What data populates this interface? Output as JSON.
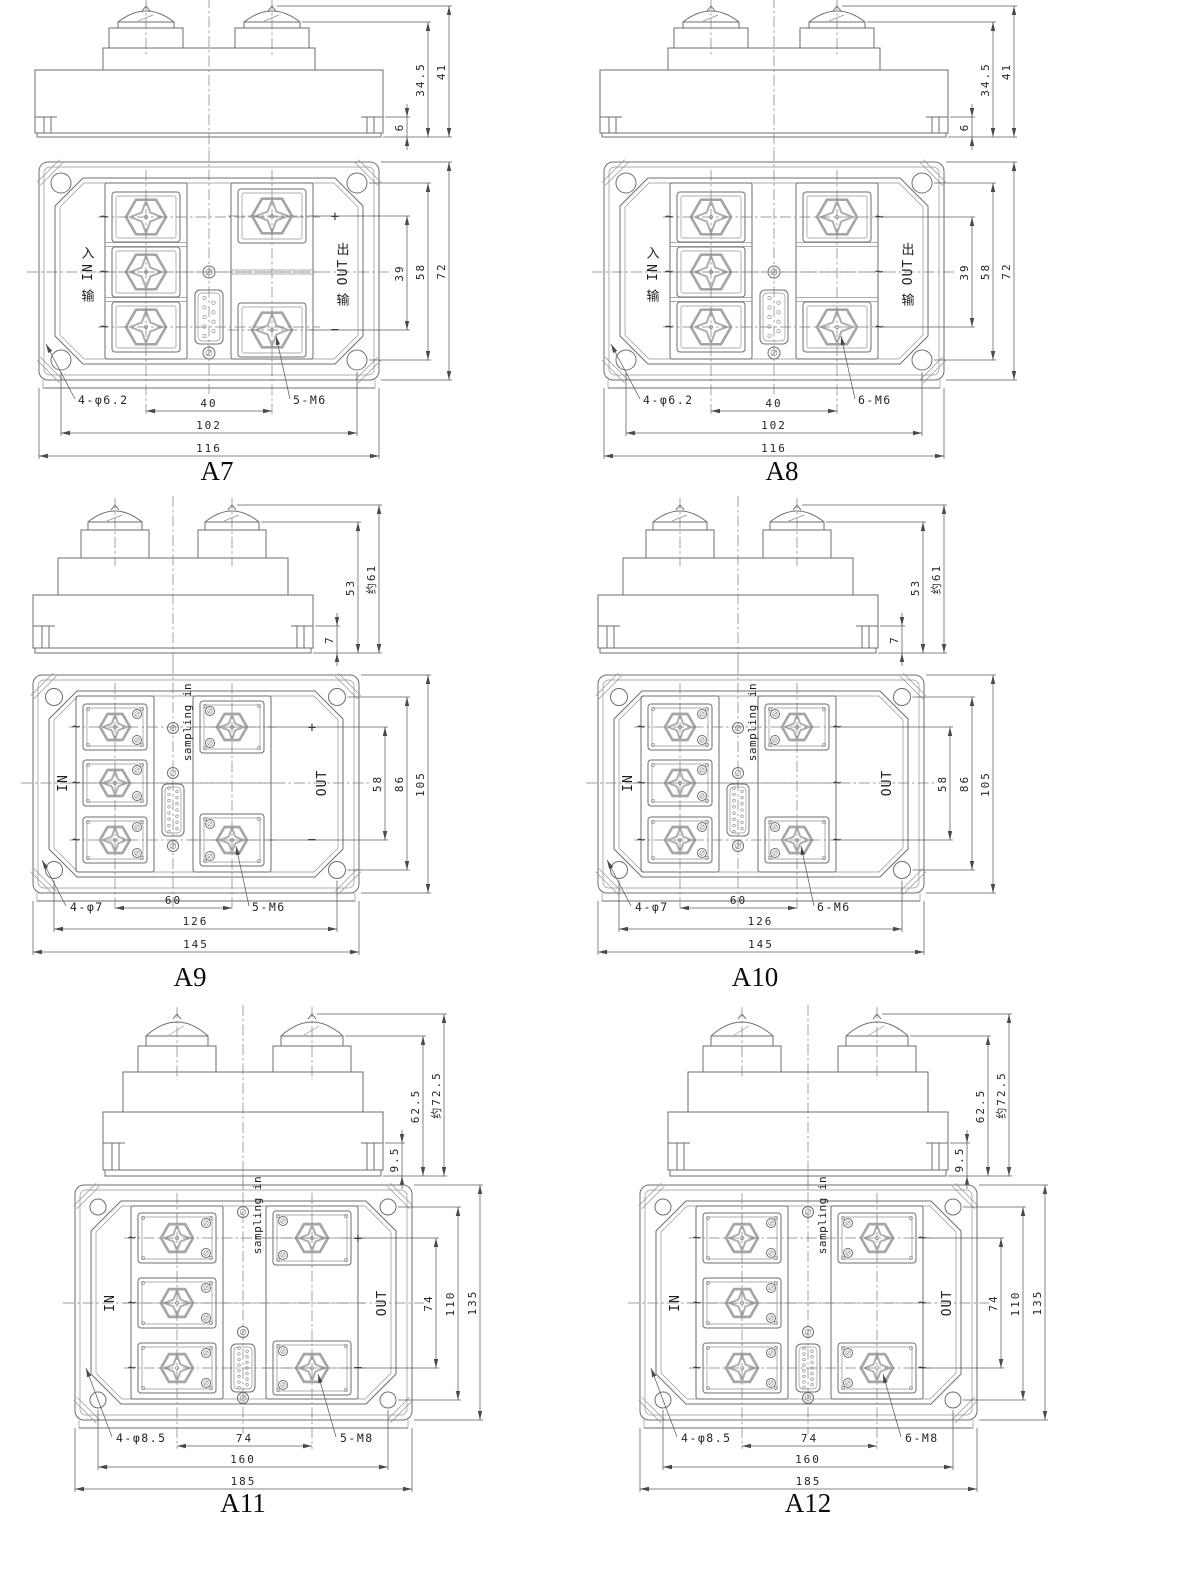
{
  "page": {
    "background": "#ffffff",
    "sheet_width": 1200,
    "sheet_height": 1596,
    "line_color": "#6e6e6e",
    "text_color": "#262626"
  },
  "symbols": {
    "plus": "+",
    "minus": "−",
    "ac_tilde": "~"
  },
  "figures": [
    {
      "id": "A7",
      "title": "A7",
      "size_class": "1",
      "style": "cn",
      "left_terminals": 3,
      "right_terminals": 2,
      "in_label": "输 IN 入",
      "out_label": "输 OUT 出",
      "sampling_label": null,
      "hole_note": "4-φ6.2",
      "terminal_note": "5-M6",
      "side_dims": [
        "6",
        "34.5",
        "41"
      ],
      "right_dims": [
        "39",
        "58",
        "72"
      ],
      "bottom_dims": [
        "40",
        "102",
        "116"
      ]
    },
    {
      "id": "A8",
      "title": "A8",
      "size_class": "1",
      "style": "cn",
      "left_terminals": 3,
      "right_terminals": 3,
      "in_label": "输 IN 入",
      "out_label": "输 OUT 出",
      "sampling_label": null,
      "hole_note": "4-φ6.2",
      "terminal_note": "6-M6",
      "side_dims": [
        "6",
        "34.5",
        "41"
      ],
      "right_dims": [
        "39",
        "58",
        "72"
      ],
      "bottom_dims": [
        "40",
        "102",
        "116"
      ]
    },
    {
      "id": "A9",
      "title": "A9",
      "size_class": "2",
      "style": "en",
      "left_terminals": 3,
      "right_terminals": 2,
      "in_label": "IN",
      "out_label": "OUT",
      "sampling_label": "sampling in",
      "hole_note": "4-φ7",
      "terminal_note": "5-M6",
      "side_dims": [
        "7",
        "53",
        "约61"
      ],
      "right_dims": [
        "58",
        "86",
        "105"
      ],
      "bottom_dims": [
        "60",
        "126",
        "145"
      ]
    },
    {
      "id": "A10",
      "title": "A10",
      "size_class": "2",
      "style": "en",
      "left_terminals": 3,
      "right_terminals": 3,
      "in_label": "IN",
      "out_label": "OUT",
      "sampling_label": "sampling in",
      "hole_note": "4-φ7",
      "terminal_note": "6-M6",
      "side_dims": [
        "7",
        "53",
        "约61"
      ],
      "right_dims": [
        "58",
        "86",
        "105"
      ],
      "bottom_dims": [
        "60",
        "126",
        "145"
      ]
    },
    {
      "id": "A11",
      "title": "A11",
      "size_class": "3",
      "style": "en",
      "left_terminals": 3,
      "right_terminals": 2,
      "in_label": "IN",
      "out_label": "OUT",
      "sampling_label": "sampling in",
      "hole_note": "4-φ8.5",
      "terminal_note": "5-M8",
      "side_dims": [
        "9.5",
        "62.5",
        "约72.5"
      ],
      "right_dims": [
        "74",
        "110",
        "135"
      ],
      "bottom_dims": [
        "74",
        "160",
        "185"
      ]
    },
    {
      "id": "A12",
      "title": "A12",
      "size_class": "3",
      "style": "en",
      "left_terminals": 3,
      "right_terminals": 3,
      "in_label": "IN",
      "out_label": "OUT",
      "sampling_label": "sampling in",
      "hole_note": "4-φ8.5",
      "terminal_note": "6-M8",
      "side_dims": [
        "9.5",
        "62.5",
        "约72.5"
      ],
      "right_dims": [
        "74",
        "110",
        "135"
      ],
      "bottom_dims": [
        "74",
        "160",
        "185"
      ]
    }
  ]
}
